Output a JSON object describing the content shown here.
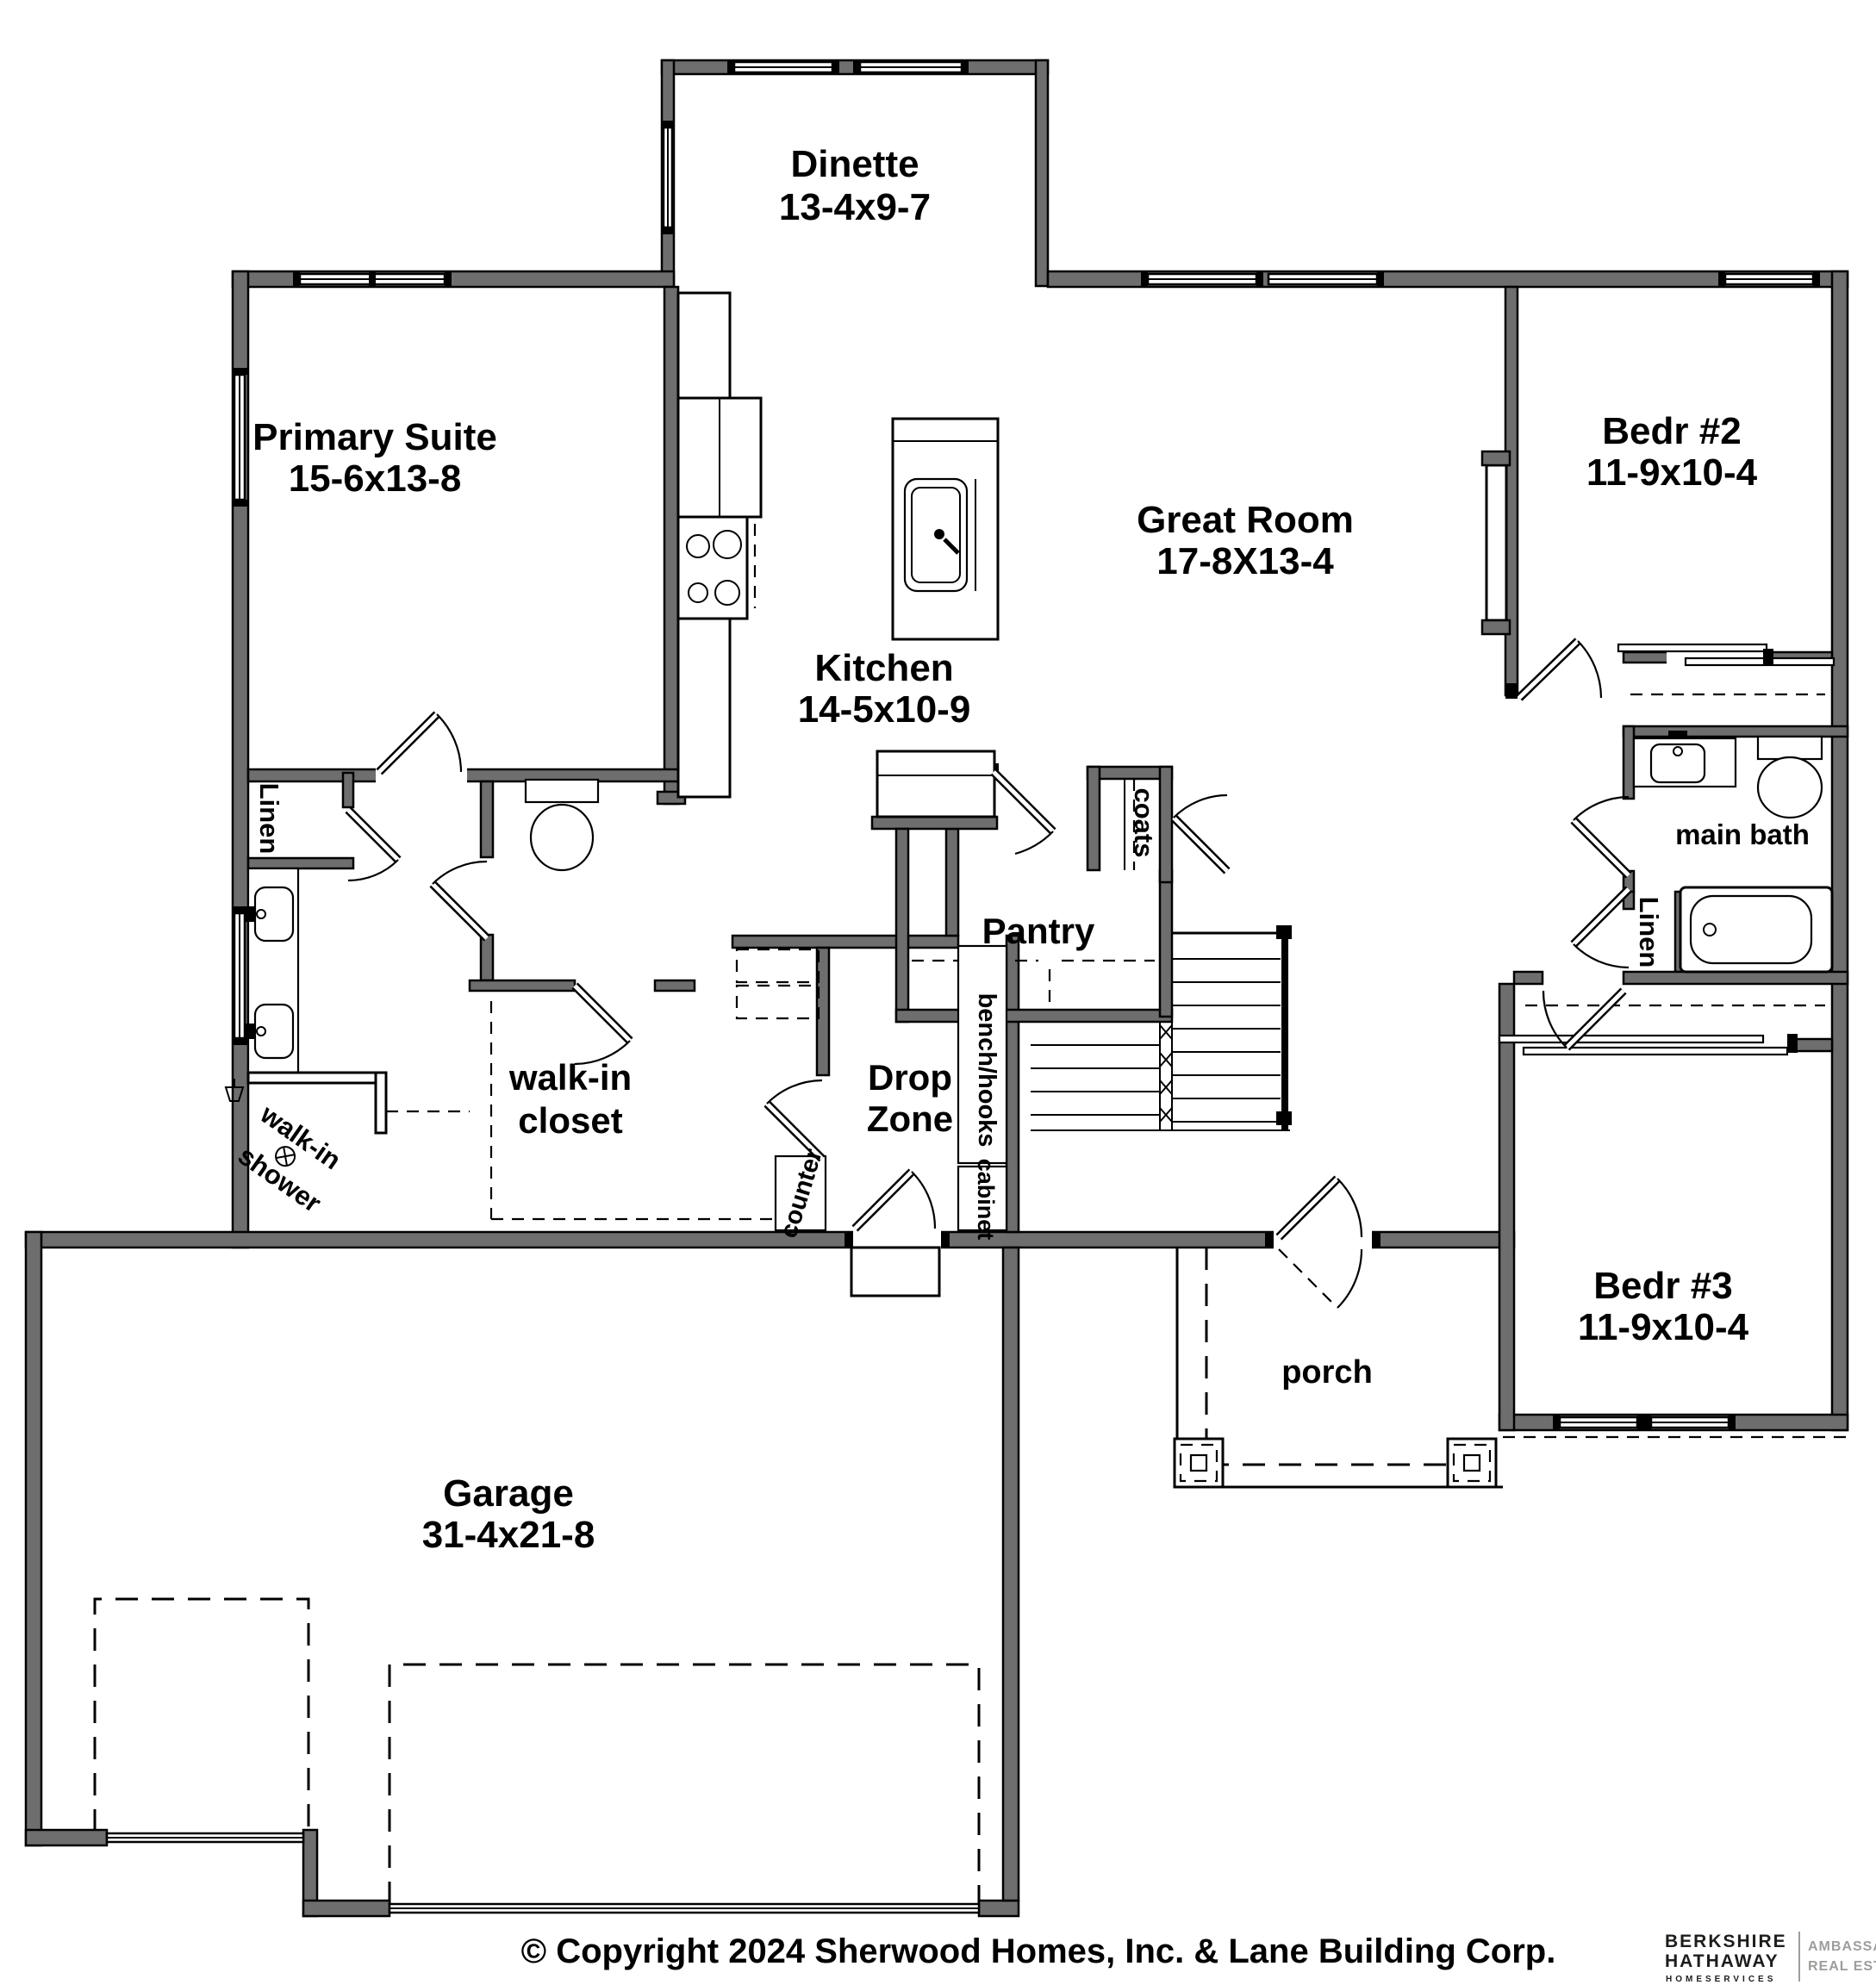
{
  "colors": {
    "wall_fill": "#6e6e6e",
    "line": "#000000",
    "background": "#ffffff",
    "logo_dark": "#1d1d1b",
    "logo_gray": "#9d9d9c"
  },
  "rooms": {
    "dinette": {
      "name": "Dinette",
      "dims": "13-4x9-7"
    },
    "primary_suite": {
      "name": "Primary Suite",
      "dims": "15-6x13-8"
    },
    "great_room": {
      "name": "Great Room",
      "dims": "17-8X13-4"
    },
    "bedroom2": {
      "name": "Bedr #2",
      "dims": "11-9x10-4"
    },
    "kitchen": {
      "name": "Kitchen",
      "dims": "14-5x10-9"
    },
    "bedroom3": {
      "name": "Bedr #3",
      "dims": "11-9x10-4"
    },
    "garage": {
      "name": "Garage",
      "dims": "31-4x21-8"
    },
    "pantry": {
      "name": "Pantry"
    },
    "porch": {
      "name": "porch"
    },
    "main_bath": {
      "name": "main bath"
    },
    "drop_zone": {
      "line1": "Drop",
      "line2": "Zone"
    },
    "walk_in_closet": {
      "line1": "walk-in",
      "line2": "closet"
    },
    "walk_in_shower": {
      "line1": "walk-in",
      "line2": "shower"
    }
  },
  "closets": {
    "linen_primary": "Linen",
    "linen_hall": "Linen",
    "coats": "coats"
  },
  "mudroom": {
    "bench": "bench/hooks",
    "cabinet": "cabinet",
    "counter": "counter"
  },
  "footer": {
    "copyright": "© Copyright 2024 Sherwood Homes, Inc. & Lane Building Corp."
  },
  "branding": {
    "company_line1": "BERKSHIRE",
    "company_line2": "HATHAWAY",
    "company_line3": "HOMESERVICES",
    "division_line1": "AMBASSADOR",
    "division_line2": "REAL ESTATE"
  }
}
